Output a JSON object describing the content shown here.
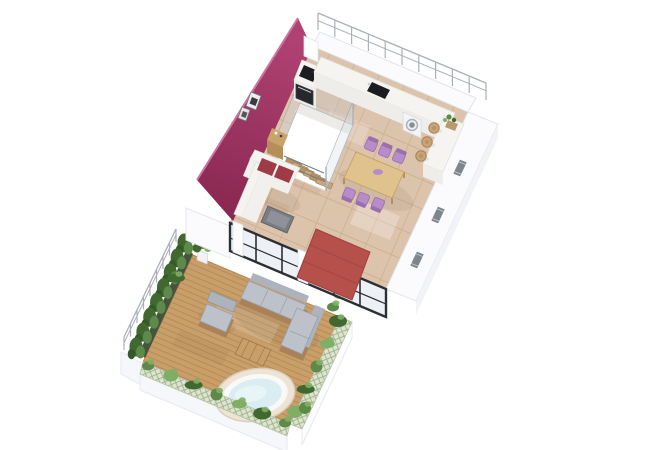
{
  "scene": {
    "description": "Isometric 3D render of an apartment floor plan with furnished roof terrace",
    "background": "#ffffff",
    "main_level": {
      "accent_wall": "magenta",
      "kitchen": {
        "appliances": [
          "cooktop",
          "oven",
          "sink",
          "washing-machine"
        ],
        "bar_stools": 3,
        "planters": 1
      },
      "dining_area": {
        "chairs": 6,
        "tables": 1
      },
      "living_area": {
        "sofas": 1,
        "accent_cushions": 2,
        "coffee_tables": 1,
        "sideboards": 1,
        "wall_art": 2
      },
      "staircase": {
        "balustrade": "glass",
        "treads": 6
      },
      "windows_in_right_wall": 3,
      "glass_door_panels": 6
    },
    "terrace": {
      "deck": "wood",
      "furniture": [
        "corner-sofa",
        "lounge-chair",
        "coffee-table",
        "hot-tub"
      ],
      "hot_tubs": 1,
      "potted_plants": 2,
      "hedge_bushes": 8,
      "ivy_clusters": 16,
      "railing": "white"
    },
    "awning": {
      "color_name": "red",
      "position": "over-terrace-doors"
    }
  },
  "palette": {
    "background": "#ffffff",
    "accent_wall": "#9e3162",
    "accent_wall_light": "#b04273",
    "accent_wall_dark": "#8a2852",
    "accent_wall_edge": "#cb76a0",
    "wall_white": "#fbfbfd",
    "wall_shade": "#f1f3f7",
    "wall_stroke": "#e2e5eb",
    "tile_floor": "#dcc3ab",
    "tile_grout": "#c2a183",
    "deck_wood": "#c99e68",
    "deck_line": "#ad8352",
    "lattice_bg": "#dde4d0",
    "lattice_line": "#9fb18c",
    "hedge_green": "#5d8a4a",
    "hedge_dark": "#40682f",
    "hedge_light": "#7fae65",
    "planter_dark": "#46543f",
    "awning_red": "#b5504b",
    "glass_frame": "#2c2f34",
    "glass_tint": "#e9eef2",
    "railing_gray": "#a9b0b8",
    "counter_white": "#f6f4f1",
    "counter_face": "#efede9",
    "appliance_dark": "#1b1d21",
    "washer_ring": "#aab0b7",
    "stool_wood": "#c9a576",
    "dining_table": "#e0c28c",
    "chair_purple": "#b78cc9",
    "chair_purple_dark": "#9a6fae",
    "sofa_white": "#f4f3f0",
    "sofa_seat": "#f1f0ec",
    "sofa_cushion": "#a03a46",
    "coffee_table": "#797c82",
    "sideboard_wood": "#c9a26c",
    "outdoor_cushion": "#bdc2ca",
    "outdoor_cushion_dark": "#adb3bc",
    "outdoor_wood": "#a98258",
    "hot_tub_rim": "#eee4d6",
    "hot_tub_water": "#d9edf2",
    "stair_wood": "#c8a87a",
    "window_gray": "#7e868d"
  }
}
